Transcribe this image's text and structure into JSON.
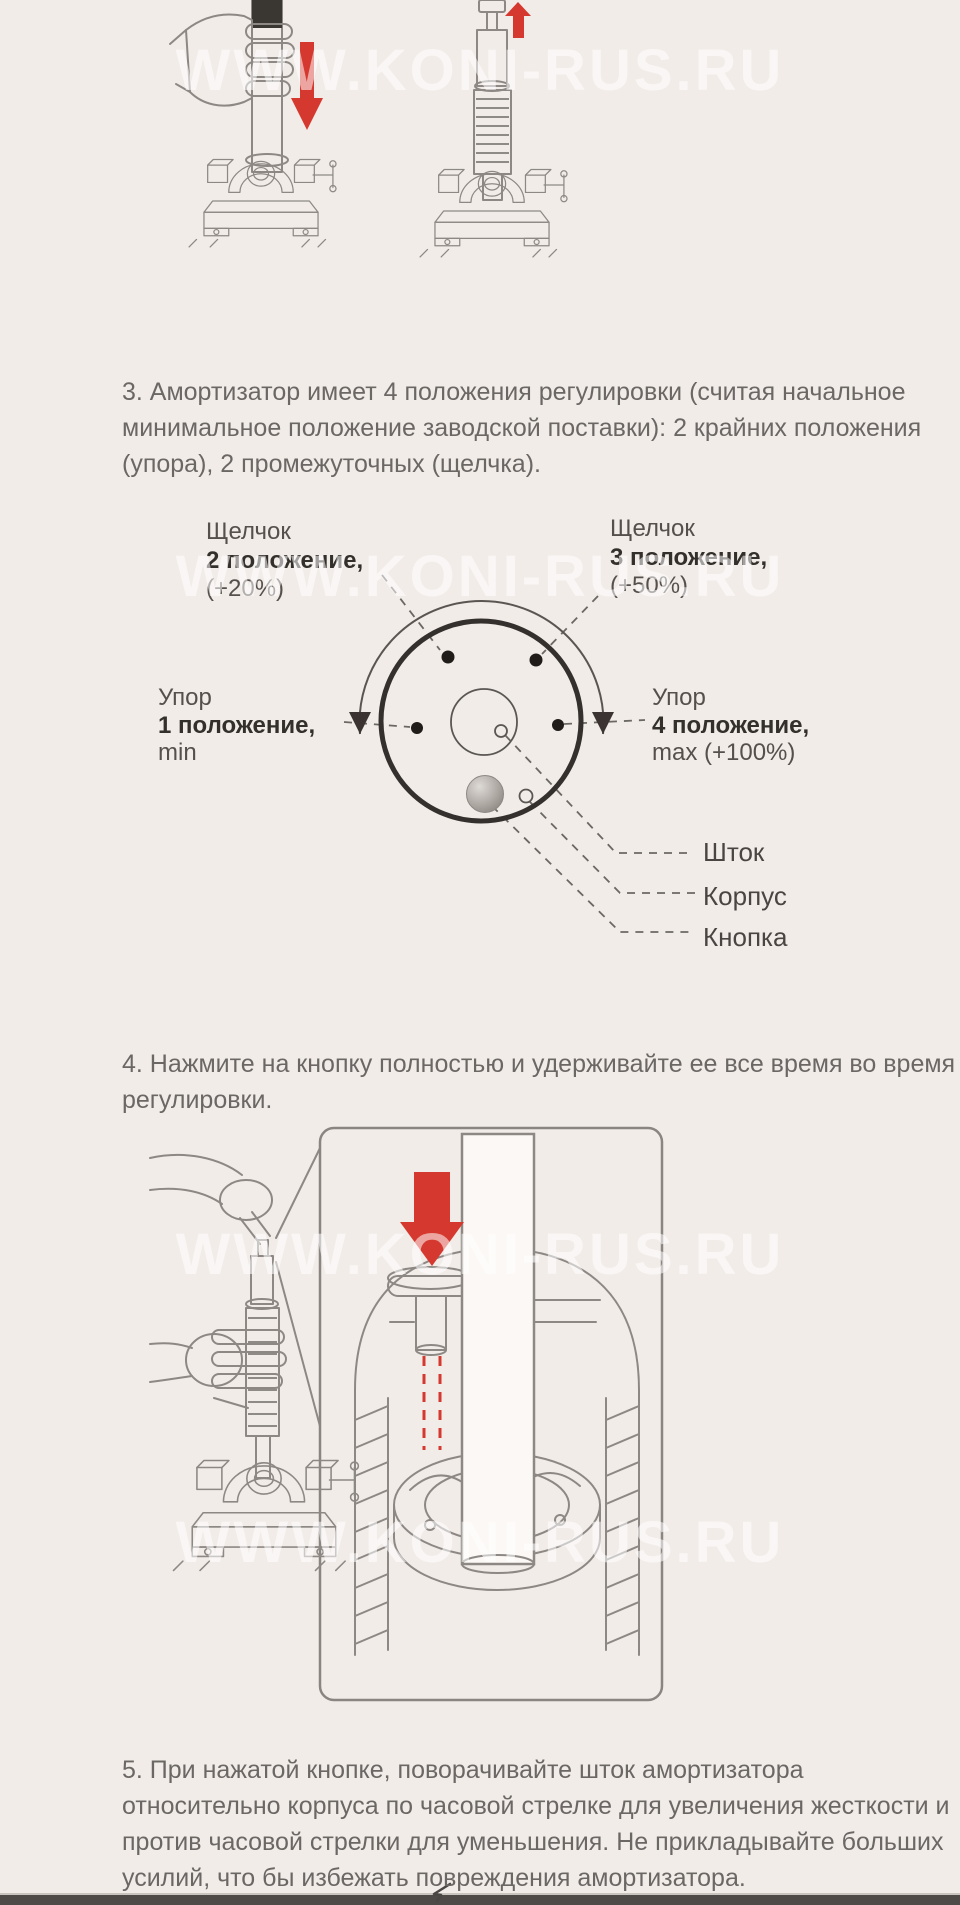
{
  "watermark": {
    "text": "WWW.KONI-RUS.RU"
  },
  "steps": {
    "step3_lines": [
      "3. Амортизатор имеет 4 положения регулировки (считая начальное",
      "минимальное положение заводской поставки): 2 крайних положения",
      "(упора), 2 промежуточных (щелчка)."
    ],
    "step4_lines": [
      "4. Нажмите на кнопку полностью и удерживайте ее все время во время",
      "регулировки."
    ],
    "step5_lines": [
      "5. При нажатой кнопке, поворачивайте шток амортизатора",
      "относительно корпуса по часовой стрелке для увеличения жесткости и",
      "против часовой стрелки для уменьшения. Не прикладывайте больших",
      "усилий, что бы избежать повреждения амортизатора."
    ]
  },
  "dial": {
    "click2": {
      "l1": "Щелчок",
      "l2": "2 положение,",
      "l3": "(+20%)"
    },
    "click3": {
      "l1": "Щелчок",
      "l2": "3 положение,",
      "l3": "(+50%)"
    },
    "stop1": {
      "l1": "Упор",
      "l2": "1 положение,",
      "l3": "min"
    },
    "stop4": {
      "l1": "Упор",
      "l2": "4 положение,",
      "l3": "max (+100%)"
    },
    "rod_label": "Шток",
    "body_label": "Корпус",
    "button_label": "Кнопка"
  },
  "colors": {
    "page_bg": "#f1ece8",
    "text": "#6b6765",
    "accent_red": "#d5382e",
    "line_art": "#8d8884",
    "dark_fill": "#38342f"
  }
}
